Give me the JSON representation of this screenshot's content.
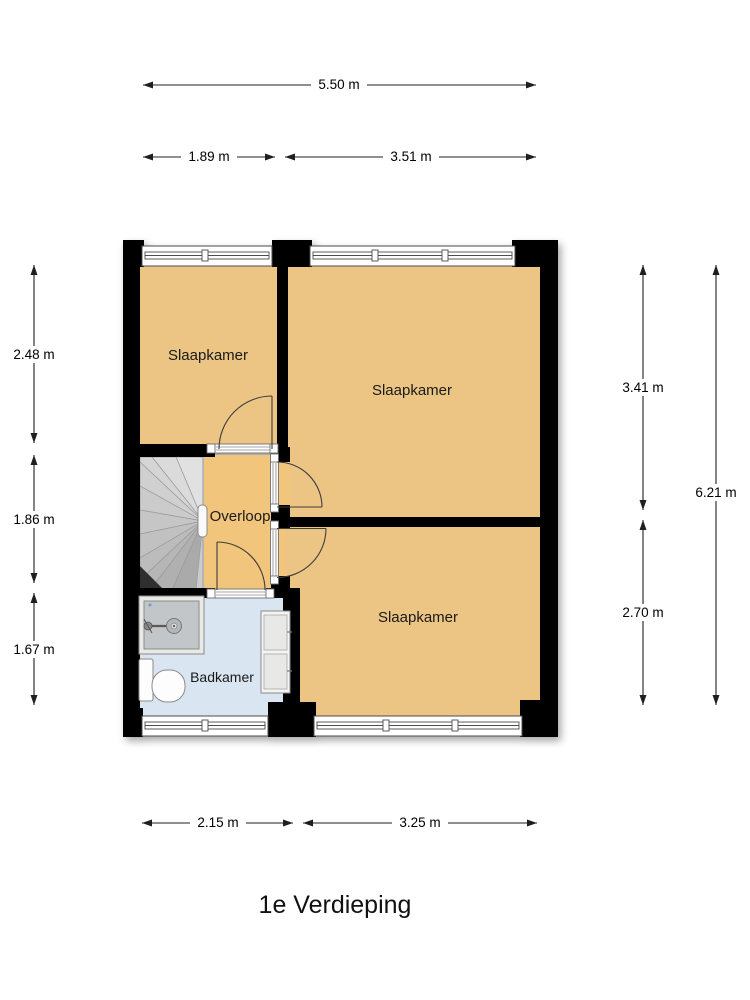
{
  "title": "1e Verdieping",
  "rooms": [
    {
      "label": "Slaapkamer"
    },
    {
      "label": "Slaapkamer"
    },
    {
      "label": "Overloop"
    },
    {
      "label": "Slaapkamer"
    },
    {
      "label": "Badkamer"
    }
  ],
  "dimensions": {
    "top_total": "5.50 m",
    "top_left": "1.89 m",
    "top_right": "3.51 m",
    "left_upper": "2.48 m",
    "left_middle": "1.86 m",
    "left_lower": "1.67 m",
    "right_upper": "3.41 m",
    "right_lower": "2.70 m",
    "right_total": "6.21 m",
    "bottom_left": "2.15 m",
    "bottom_right": "3.25 m"
  },
  "colors": {
    "wall": "#000000",
    "bedroom_fill": "#ecc584",
    "landing_fill": "#f1c57c",
    "bathroom_fill": "#d9e6f2",
    "stairs_fill": "#cccccc"
  },
  "fixtures": [
    {
      "name": "stairs"
    },
    {
      "name": "shower"
    },
    {
      "name": "toilet"
    },
    {
      "name": "cabinet"
    }
  ]
}
